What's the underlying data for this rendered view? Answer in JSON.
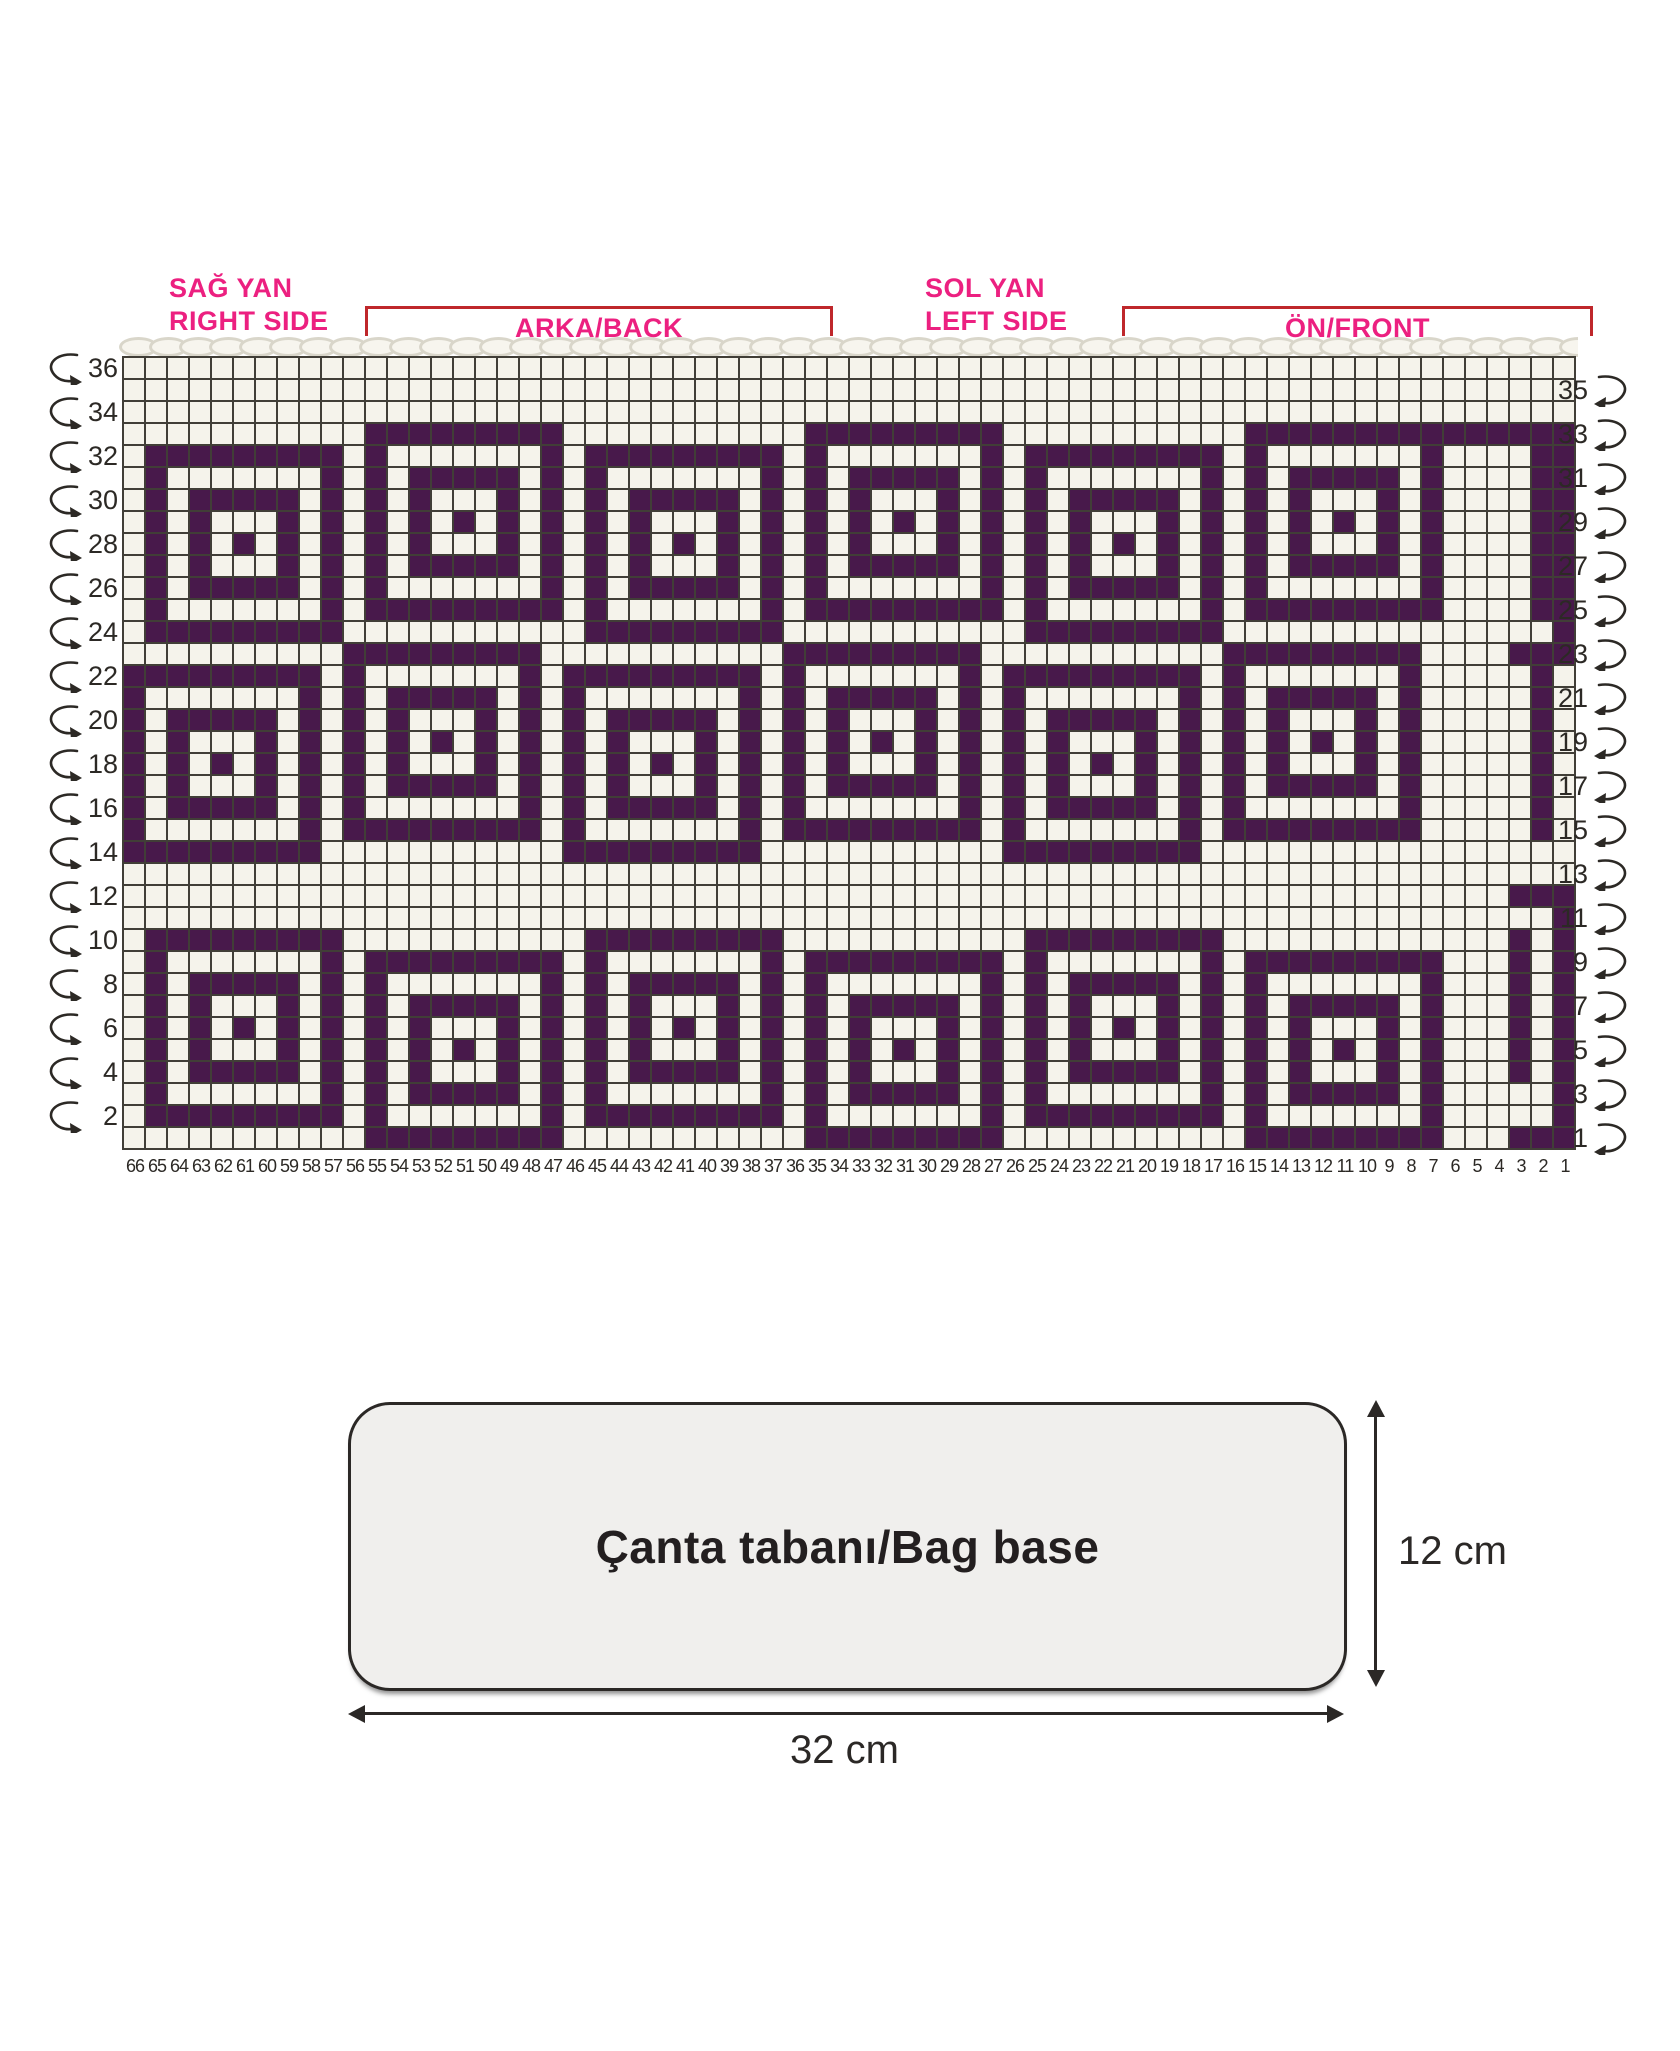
{
  "sections": {
    "right_side": {
      "line1": "SAĞ YAN",
      "line2": "RIGHT SIDE"
    },
    "back": {
      "label": "ARKA/BACK"
    },
    "left_side": {
      "line1": "SOL YAN",
      "line2": "LEFT SIDE"
    },
    "front": {
      "label": "ÖN/FRONT"
    }
  },
  "bag_base": {
    "label": "Çanta tabanı/Bag base",
    "height_dim": "12 cm",
    "width_dim": "32 cm"
  },
  "colors": {
    "stitch_purple": "#48194b",
    "stitch_cream": "#f5f3eb",
    "grid_line": "#413e37",
    "label_pink": "#ec2080",
    "bracket_red": "#bf272b",
    "text_dark": "#2c2925",
    "chain_outline": "#d9d6ca",
    "bag_base_fill": "#f0efed"
  },
  "chart_data": {
    "type": "heatmap",
    "title": "Tapestry crochet bag colorwork chart",
    "columns": 66,
    "rows": 36,
    "legend": {
      "#": "purple stitch",
      ".": "cream stitch"
    },
    "row_numbers_left": [
      "36",
      "34",
      "32",
      "30",
      "28",
      "26",
      "24",
      "22",
      "20",
      "18",
      "16",
      "14",
      "12",
      "10",
      "8",
      "6",
      "4",
      "2"
    ],
    "row_numbers_right": [
      "35",
      "33",
      "31",
      "29",
      "27",
      "25",
      "23",
      "21",
      "19",
      "17",
      "15",
      "13",
      "11",
      "9",
      "7",
      "5",
      "3",
      "1"
    ],
    "column_numbers": [
      "66",
      "65",
      "64",
      "63",
      "62",
      "61",
      "60",
      "59",
      "58",
      "57",
      "56",
      "55",
      "54",
      "53",
      "52",
      "51",
      "50",
      "49",
      "48",
      "47",
      "46",
      "45",
      "44",
      "43",
      "42",
      "41",
      "40",
      "39",
      "38",
      "37",
      "36",
      "35",
      "34",
      "33",
      "32",
      "31",
      "30",
      "29",
      "28",
      "27",
      "26",
      "25",
      "24",
      "23",
      "22",
      "21",
      "20",
      "19",
      "18",
      "17",
      "16",
      "15",
      "14",
      "13",
      "12",
      "11",
      "10",
      "9",
      "8",
      "7",
      "6",
      "5",
      "4",
      "3",
      "2",
      "1"
    ],
    "chain_stitch_count": 59,
    "grid_rows": [
      "..................................................................",
      "..................................................................",
      "..................................................................",
      "...........#########...........#########...........###############",
      ".#########.#.......#.#########.#.......#.#########.#.......#....##",
      ".#.......#.#.#####.#.#.......#.#.#####.#.#.......#.#.#####.#....##",
      ".#.#####.#.#.#...#.#.#.#####.#.#.#...#.#.#.#####.#.#.#...#.#....##",
      ".#.#...#.#.#.#.#.#.#.#.#...#.#.#.#.#.#.#.#.#...#.#.#.#.#.#.#....##",
      ".#.#.#.#.#.#.#...#.#.#.#.#.#.#.#.#...#.#.#.#.#.#.#.#.#...#.#....##",
      ".#.#...#.#.#.#####.#.#.#...#.#.#.#####.#.#.#...#.#.#.#####.#....##",
      ".#.#####.#.#.......#.#.#####.#.#.......#.#.#####.#.#.......#....##",
      ".#.......#.#########.#.......#.#########.#.......#.#########....##",
      ".#########...........#########...........#########...............#",
      "..........#########...........#########...........#########....###",
      "#########.#.......#.#########.#.......#.#########.#.......#.....#.",
      "#.......#.#.#####.#.#.......#.#.#####.#.#.......#.#.#####.#.....#.",
      "#.#####.#.#.#...#.#.#.#####.#.#.#...#.#.#.#####.#.#.#...#.#.....#.",
      "#.#...#.#.#.#.#.#.#.#.#...#.#.#.#.#.#.#.#.#...#.#.#.#.#.#.#.....#.",
      "#.#.#.#.#.#.#...#.#.#.#.#.#.#.#.#...#.#.#.#.#.#.#.#.#...#.#.....#.",
      "#.#...#.#.#.#####.#.#.#...#.#.#.#####.#.#.#...#.#.#.#####.#.....#.",
      "#.#####.#.#.......#.#.#####.#.#.......#.#.#####.#.#.......#.....#.",
      "#.......#.#########.#.......#.#########.#.......#.#########.....#.",
      "#########...........#########...........#########.................",
      "..................................................................",
      "...............................................................###",
      ".................................................................#",
      ".#########...........#########...........#########.............#.#",
      ".#.......#.#########.#.......#.#########.#.......#.#########...#.#",
      ".#.#####.#.#.......#.#.#####.#.#.......#.#.#####.#.#.......#...#.#",
      ".#.#...#.#.#.#####.#.#.#...#.#.#.#####.#.#.#...#.#.#.#####.#...#.#",
      ".#.#.#.#.#.#.#...#.#.#.#.#.#.#.#.#...#.#.#.#.#.#.#.#.#...#.#...#.#",
      ".#.#...#.#.#.#.#.#.#.#.#...#.#.#.#.#.#.#.#.#...#.#.#.#.#.#.#...#.#",
      ".#.#####.#.#.#...#.#.#.#####.#.#.#...#.#.#.#####.#.#.#...#.#...#.#",
      ".#.......#.#.#####.#.#.......#.#.#####.#.#.......#.#.#####.#.....#",
      ".#########.#.......#.#########.#.......#.#########.#.......#.....#",
      "...........#########...........#########...........#########...###"
    ]
  }
}
